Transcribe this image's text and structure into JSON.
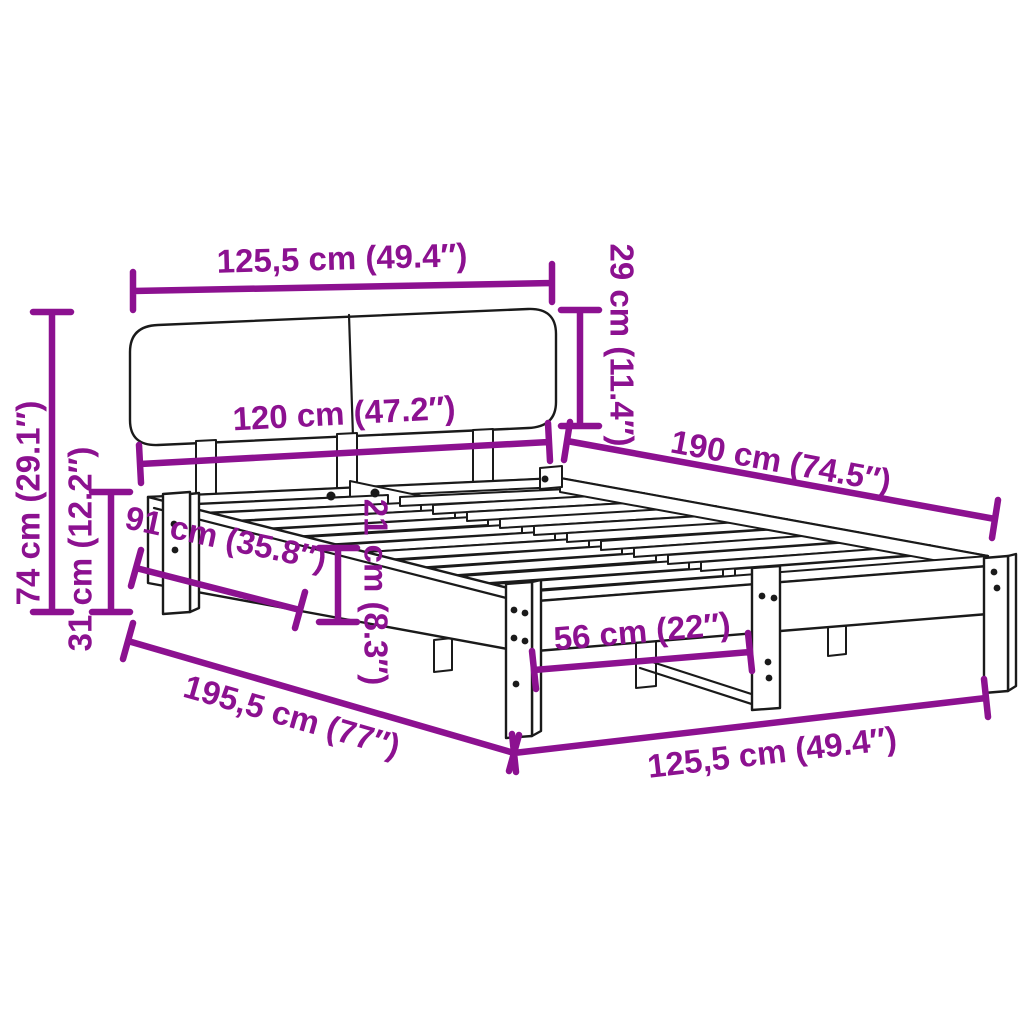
{
  "colors": {
    "accent": "#8C1190",
    "ink": "#1A1A1A",
    "background": "#FFFFFF"
  },
  "diagram": {
    "subject": "bed frame with headboard and slatted base — dimension diagram",
    "dimensions": [
      {
        "id": "headboard-width",
        "label": "125,5 cm (49.4″)"
      },
      {
        "id": "headboard-height",
        "label": "29 cm (11.4″)"
      },
      {
        "id": "inner-width",
        "label": "120 cm (47.2″)"
      },
      {
        "id": "inner-length",
        "label": "190 cm (74.5″)"
      },
      {
        "id": "overall-height",
        "label": "74 cm (29.1″)"
      },
      {
        "id": "frame-height",
        "label": "31 cm (12.2″)"
      },
      {
        "id": "head-to-front-leg",
        "label": "91 cm (35.8″)"
      },
      {
        "id": "side-board-height",
        "label": "21 cm (8.3″)"
      },
      {
        "id": "overall-length",
        "label": "195,5 cm (77″)"
      },
      {
        "id": "leg-spacing",
        "label": "56 cm (22″)"
      },
      {
        "id": "overall-width",
        "label": "125,5 cm (49.4″)"
      }
    ]
  }
}
